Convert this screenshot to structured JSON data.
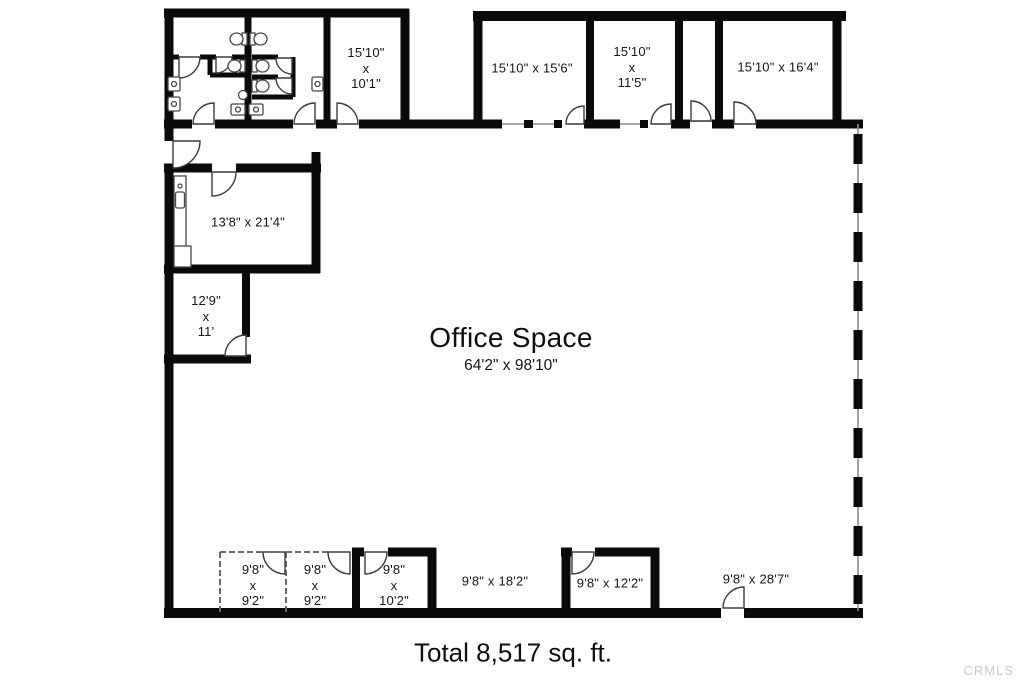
{
  "floorplan": {
    "office": {
      "name": "Office Space",
      "dims": "64'2\" x 98'10\""
    },
    "total": "Total 8,517 sq. ft.",
    "watermark": "CRMLS",
    "colors": {
      "walls": "#0a0a0a",
      "watermark_text": "#c9c9c9"
    },
    "rooms": [
      {
        "id": "top-room-1",
        "label": "15'10\"\nx\n10'1\""
      },
      {
        "id": "top-room-2",
        "label": "15'10\" x 15'6\""
      },
      {
        "id": "top-room-3",
        "label": "15'10\"\nx\n11'5\""
      },
      {
        "id": "top-room-4",
        "label": "15'10\" x 16'4\""
      },
      {
        "id": "left-room-1",
        "label": "13'8\" x 21'4\""
      },
      {
        "id": "left-room-2",
        "label": "12'9\"\nx\n11'"
      },
      {
        "id": "bottom-room-1",
        "label": "9'8\"\nx\n9'2\""
      },
      {
        "id": "bottom-room-2",
        "label": "9'8\"\nx\n9'2\""
      },
      {
        "id": "bottom-room-3",
        "label": "9'8\"\nx\n10'2\""
      },
      {
        "id": "bottom-area-1",
        "label": "9'8\" x 18'2\""
      },
      {
        "id": "bottom-room-4",
        "label": "9'8\" x 12'2\""
      },
      {
        "id": "bottom-area-2",
        "label": "9'8\" x 28'7\""
      }
    ]
  }
}
